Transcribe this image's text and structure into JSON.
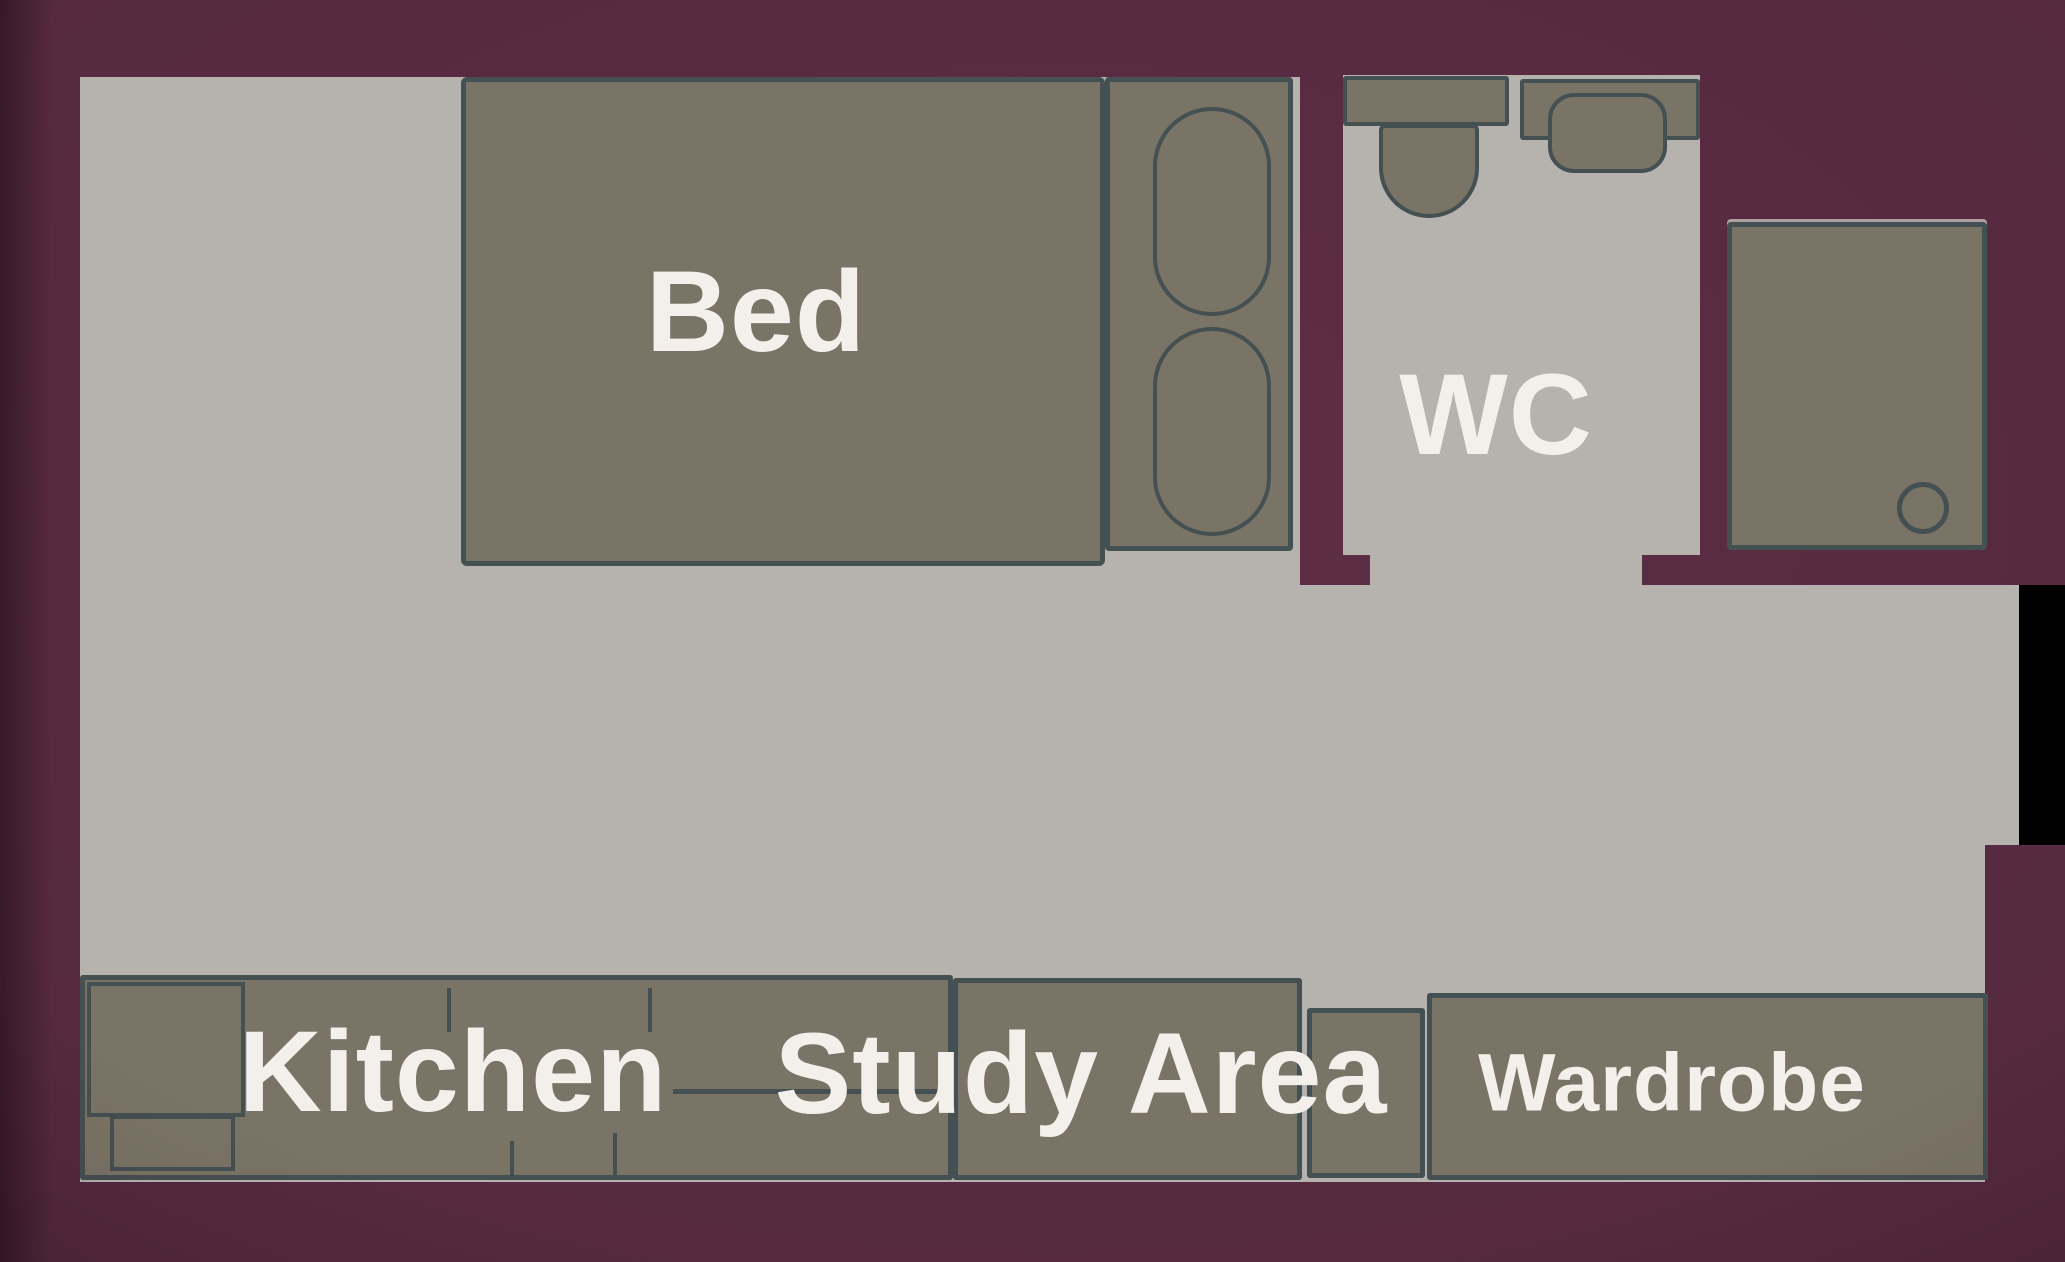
{
  "labels": {
    "bed": "Bed",
    "wc": "WC",
    "kitchen": "Kitchen",
    "study": "Study Area",
    "wardrobe": "Wardrobe"
  },
  "icons": {
    "toilet": "css-shape: tank rectangle + U-shaped bowl",
    "sink": "css-shape: counter rectangle + rounded basin",
    "shower_drain": "css-shape: outlined circle",
    "bed_pillows": "css-shape: two outlined stadium ovals"
  },
  "colors": {
    "background_center": "#5e2e45",
    "background_mid": "#552940",
    "background_edge": "#432033",
    "floor": "#b6b3ae",
    "furniture": "#7a7466",
    "outline": "#455052",
    "label_text": "#f3f0ec",
    "void": "#000000"
  }
}
